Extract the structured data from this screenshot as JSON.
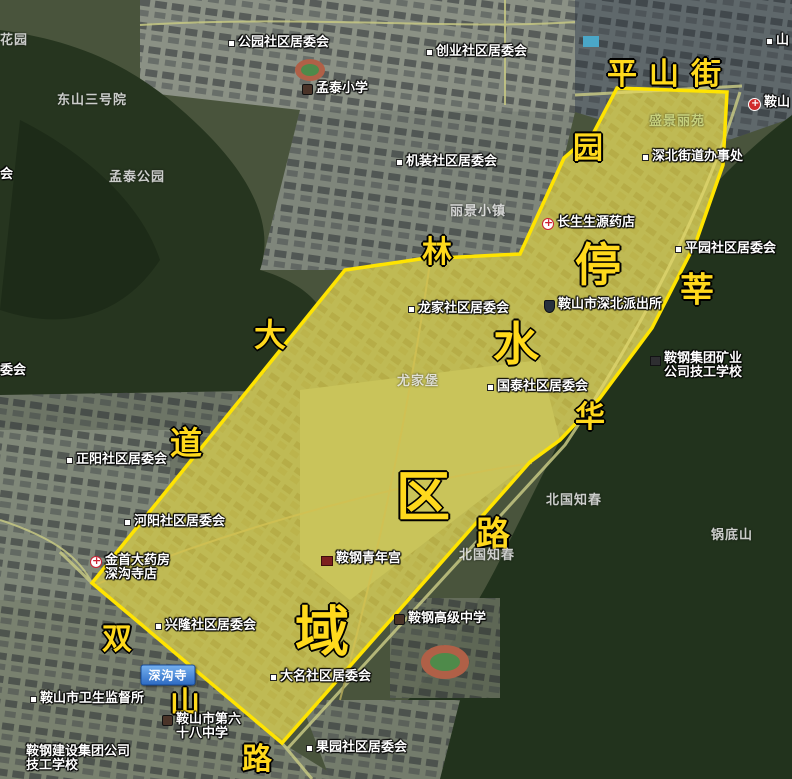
{
  "region": {
    "points": "617,88 727,92 723,165 696,242 652,328 600,398 560,440 530,462 282,743 92,583 345,270 420,259 520,254 564,158 594,132",
    "fill": "rgba(255,230,70,0.38)",
    "stroke": "#ffe400"
  },
  "street_labels": [
    {
      "text": "平山街",
      "x": 670,
      "y": 71,
      "size": 30,
      "spacing": 12
    },
    {
      "text": "园",
      "x": 588,
      "y": 145,
      "size": 30
    },
    {
      "text": "林",
      "x": 437,
      "y": 249,
      "size": 30
    },
    {
      "text": "停",
      "x": 598,
      "y": 262,
      "size": 46
    },
    {
      "text": "水",
      "x": 516,
      "y": 341,
      "size": 46
    },
    {
      "text": "区",
      "x": 423,
      "y": 492,
      "size": 54
    },
    {
      "text": "域",
      "x": 322,
      "y": 627,
      "size": 54
    },
    {
      "text": "莘",
      "x": 697,
      "y": 287,
      "size": 34
    },
    {
      "text": "华",
      "x": 590,
      "y": 414,
      "size": 30
    },
    {
      "text": "路",
      "x": 493,
      "y": 531,
      "size": 34
    },
    {
      "text": "大",
      "x": 270,
      "y": 333,
      "size": 32
    },
    {
      "text": "道",
      "x": 186,
      "y": 441,
      "size": 32
    },
    {
      "text": "双",
      "x": 117,
      "y": 636,
      "size": 30
    },
    {
      "text": "山",
      "x": 185,
      "y": 700,
      "size": 30
    },
    {
      "text": "路",
      "x": 257,
      "y": 756,
      "size": 30
    }
  ],
  "poi_labels": [
    {
      "text": "公园社区居委会",
      "x": 228,
      "y": 36,
      "icon": "dot"
    },
    {
      "text": "创业社区居委会",
      "x": 426,
      "y": 45,
      "icon": "dot"
    },
    {
      "text": "孟泰小学",
      "x": 302,
      "y": 82,
      "icon": "school"
    },
    {
      "text": "机装社区居委会",
      "x": 396,
      "y": 155,
      "icon": "dot"
    },
    {
      "text": "长生生源药店",
      "x": 542,
      "y": 216,
      "icon": "pharmacy"
    },
    {
      "text": "深北街道办事处",
      "x": 642,
      "y": 150,
      "icon": "dot"
    },
    {
      "text": "平园社区居委会",
      "x": 675,
      "y": 242,
      "icon": "dot"
    },
    {
      "text": "龙家社区居委会",
      "x": 408,
      "y": 302,
      "icon": "dot"
    },
    {
      "text": "鞍山市深北派出所",
      "x": 544,
      "y": 298,
      "icon": "police"
    },
    {
      "text": "国泰社区居委会",
      "x": 487,
      "y": 380,
      "icon": "dot"
    },
    {
      "text": "鞍钢集团矿业",
      "text2": "公司技工学校",
      "x": 650,
      "y": 352,
      "icon": "building"
    },
    {
      "text": "正阳社区居委会",
      "x": 66,
      "y": 453,
      "icon": "dot"
    },
    {
      "text": "河阳社区居委会",
      "x": 124,
      "y": 515,
      "icon": "dot"
    },
    {
      "text": "金首大药房",
      "text2": "深沟寺店",
      "x": 90,
      "y": 554,
      "icon": "pharmacy"
    },
    {
      "text": "鞍钢青年宫",
      "x": 321,
      "y": 552,
      "icon": "youth"
    },
    {
      "text": "兴隆社区居委会",
      "x": 155,
      "y": 619,
      "icon": "dot"
    },
    {
      "text": "鞍钢高级中学",
      "x": 394,
      "y": 612,
      "icon": "school"
    },
    {
      "text": "大名社区居委会",
      "x": 270,
      "y": 670,
      "icon": "dot"
    },
    {
      "text": "鞍山市卫生监督所",
      "x": 30,
      "y": 692,
      "icon": "dot"
    },
    {
      "text": "鞍山市第六",
      "text2": "十八中学",
      "x": 162,
      "y": 713,
      "icon": "school"
    },
    {
      "text": "鞍钢建设集团公司",
      "text2": "技工学校",
      "x": 26,
      "y": 745,
      "icon": "none"
    },
    {
      "text": "果园社区居委会",
      "x": 306,
      "y": 741,
      "icon": "dot"
    },
    {
      "text": "鞍山",
      "x": 748,
      "y": 96,
      "icon": "hospital"
    },
    {
      "text": "山",
      "x": 766,
      "y": 34,
      "icon": "dot"
    },
    {
      "text": "委会",
      "x": 0,
      "y": 364,
      "icon": "none"
    },
    {
      "text": "会",
      "x": 0,
      "y": 168,
      "icon": "none"
    }
  ],
  "area_labels": [
    {
      "text": "花园",
      "x": 0,
      "y": 29,
      "tone": "white"
    },
    {
      "text": "东山三号院",
      "x": 57,
      "y": 89,
      "tone": "white"
    },
    {
      "text": "孟泰公园",
      "x": 109,
      "y": 166,
      "tone": "white"
    },
    {
      "text": "丽景小镇",
      "x": 450,
      "y": 200,
      "tone": "white"
    },
    {
      "text": "盛景丽苑",
      "x": 649,
      "y": 110,
      "tone": "greenish"
    },
    {
      "text": "尤家堡",
      "x": 397,
      "y": 370,
      "tone": "white"
    },
    {
      "text": "北国知春",
      "x": 546,
      "y": 489,
      "tone": "white"
    },
    {
      "text": "北国知春",
      "x": 459,
      "y": 544,
      "tone": "white"
    },
    {
      "text": "锅底山",
      "x": 711,
      "y": 524,
      "tone": "white"
    }
  ],
  "badge": {
    "text": "深沟寺",
    "x": 168,
    "y": 675
  }
}
